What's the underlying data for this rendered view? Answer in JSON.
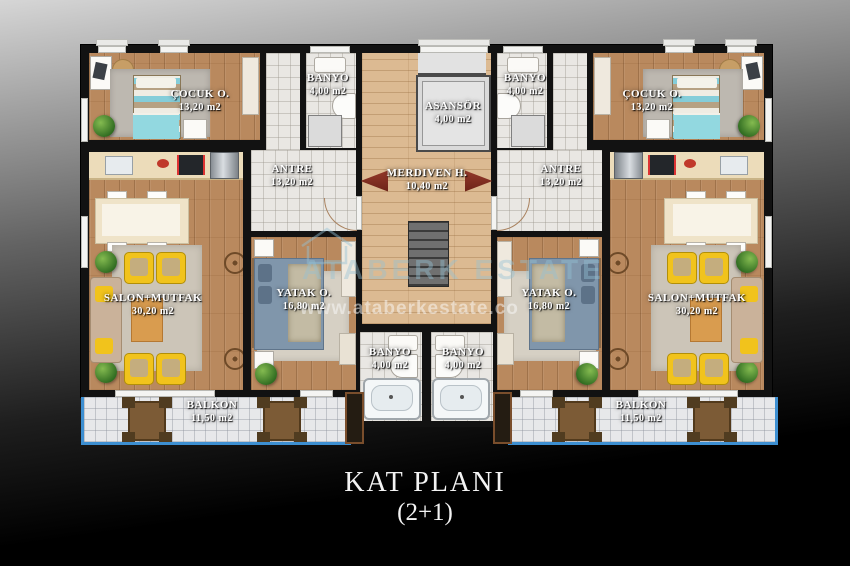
{
  "caption": {
    "line1": "KAT PLANI",
    "line2": "(2+1)"
  },
  "watermark": {
    "brand": "ATABERK ESTATE",
    "url": "www.ataberkestate.co",
    "logo": "house-outline-icon"
  },
  "core": {
    "asansor": {
      "name": "ASANSÖR",
      "area": "4,00 m2"
    },
    "merdiven": {
      "name": "MERDIVEN H.",
      "area": "10,40 m2"
    }
  },
  "apartments": {
    "left": {
      "cocuk": {
        "name": "ÇOCUK O.",
        "area": "13,20 m2"
      },
      "banyo_ust": {
        "name": "BANYO",
        "area": "4,00 m2"
      },
      "antre": {
        "name": "ANTRE",
        "area": "13,20 m2"
      },
      "salon": {
        "name": "SALON+MUTFAK",
        "area": "30,20 m2"
      },
      "yatak": {
        "name": "YATAK O.",
        "area": "16,80 m2"
      },
      "banyo_alt": {
        "name": "BANYO",
        "area": "4,00 m2"
      },
      "balkon": {
        "name": "BALKON",
        "area": "11,50 m2"
      }
    },
    "right": {
      "cocuk": {
        "name": "ÇOCUK O.",
        "area": "13,20 m2"
      },
      "banyo_ust": {
        "name": "BANYO",
        "area": "4,00 m2"
      },
      "antre": {
        "name": "ANTRE",
        "area": "13,20 m2"
      },
      "salon": {
        "name": "SALON+MUTFAK",
        "area": "30,20 m2"
      },
      "yatak": {
        "name": "YATAK O.",
        "area": "16,80 m2"
      },
      "banyo_alt": {
        "name": "BANYO",
        "area": "4,00 m2"
      },
      "balkon": {
        "name": "BALKON",
        "area": "11,50 m2"
      }
    }
  },
  "colors": {
    "wall": "#121212",
    "wood": "#b9895e",
    "wood_light": "#dcba92",
    "tile": "#e9e7e3",
    "balcony_rail": "#3d8fd1",
    "armchair_yellow": "#f1c31c",
    "arrow": "#7e2d22"
  }
}
